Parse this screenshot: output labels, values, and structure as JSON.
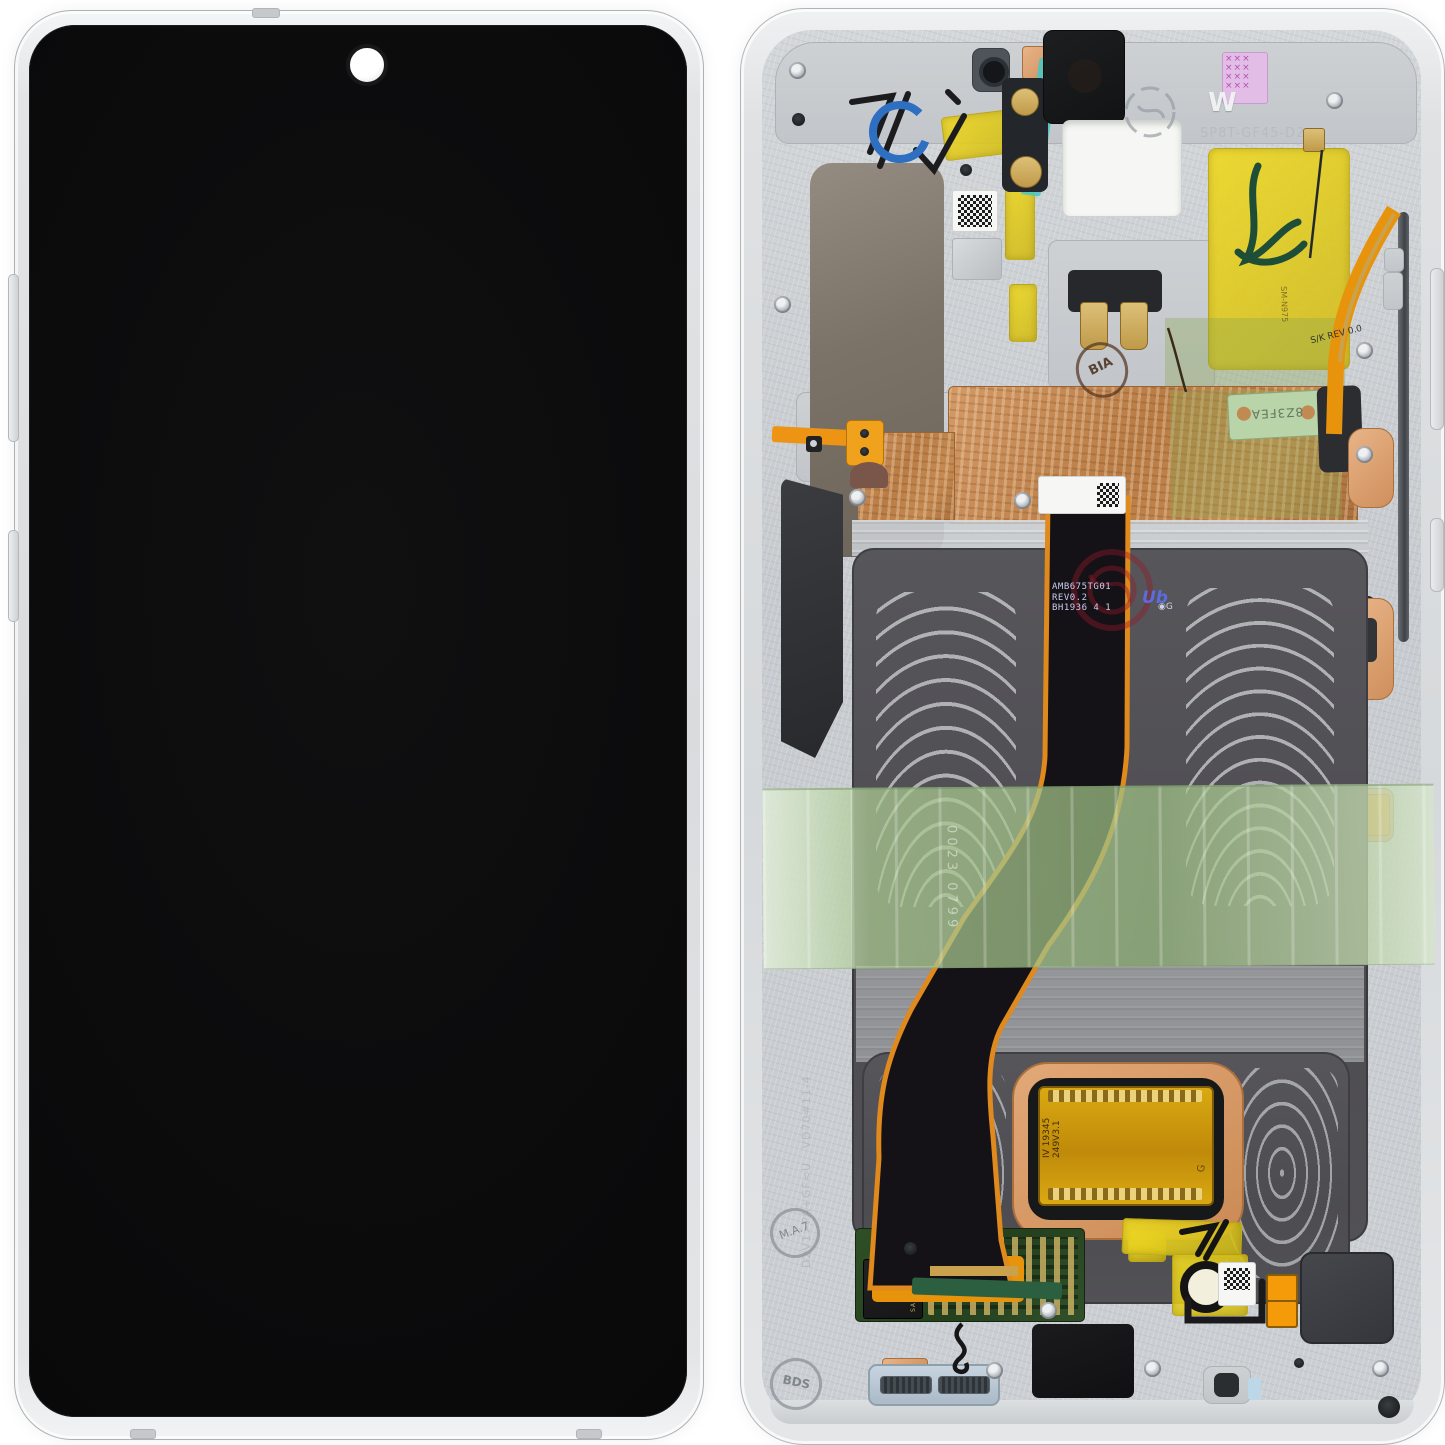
{
  "back": {
    "engraved_w": "W",
    "engraved_code": "SP8T-GF45-D2",
    "rail_code_1": "D2V1>PA+GF<U",
    "rail_code_2": "VD70#11-4",
    "stamp_ma": "M.A.7",
    "stamp_bds": "BDS",
    "stamp_bia": "BIA",
    "cof_line1": "AMB675TG01",
    "cof_line2": "REV0.2",
    "cof_line3": "BH1936 4 1",
    "cof_logo": "Ub",
    "cof_logo_g": "◉G",
    "connector_line1": "IV 19345",
    "connector_line2": "249V3.1",
    "flex_rev": "S/K REV 0.0",
    "flex_model": "SM-N975",
    "pcb_strip": "8Z3FEA",
    "tape_print": "0023 0799",
    "chip_brand": "SAMSUNG"
  },
  "colors": {
    "kapton_yellow": "#ddca1f",
    "copper_foil": "#c08450",
    "tape_green": "#a8c79a",
    "teal_flex": "#57c3bf",
    "pcb_green": "#2e4f26",
    "orange_flex": "#ee9414",
    "sticker_pink": "#dfb9e4",
    "frame_silver": "#d6d9db",
    "screen_black": "#0a0a0b"
  }
}
